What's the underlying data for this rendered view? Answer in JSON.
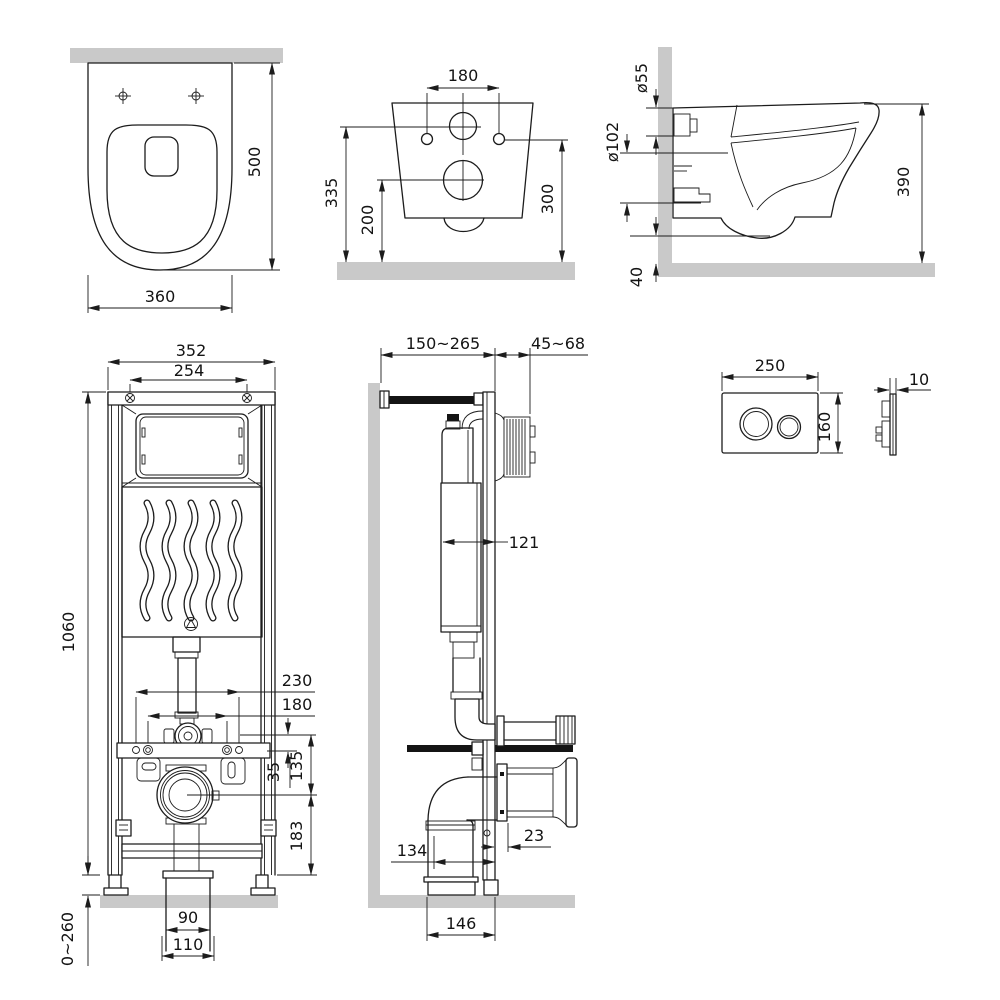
{
  "colors": {
    "surface": "#c9c9c9",
    "line": "#1c1c1c",
    "black_fill": "#141414"
  },
  "views": {
    "toilet_top": {
      "name": "Toilet bowl — top view",
      "dim_depth": "500",
      "dim_width": "360"
    },
    "toilet_rear": {
      "name": "Toilet bowl — rear view",
      "dim_hole_spacing": "180",
      "dim_inlet_height": "335",
      "dim_outlet_height": "200",
      "dim_fixing_height": "300"
    },
    "toilet_side": {
      "name": "Toilet bowl — side view",
      "dim_inlet_dia": "ø55",
      "dim_outlet_dia": "ø102",
      "dim_height": "390",
      "dim_floor_gap": "40"
    },
    "frame_front": {
      "name": "Installation frame — front view",
      "dim_width": "352",
      "dim_screw_spacing": "254",
      "dim_height": "1060",
      "dim_stud_outer": "230",
      "dim_stud_inner": "180",
      "dim_offset_small": "35",
      "dim_rail_to_outlet": "135",
      "dim_outlet_to_base": "183",
      "dim_leg_range": "0~260",
      "dim_drain_inner": "90",
      "dim_drain_outer": "110"
    },
    "frame_side": {
      "name": "Installation frame — side view",
      "dim_depth_range": "150~265",
      "dim_finish_range": "45~68",
      "dim_cistern_depth": "121",
      "dim_outlet_depth": "134",
      "dim_flange_depth": "23",
      "dim_drain_depth": "146"
    },
    "flush_plate": {
      "name": "Flush plate",
      "dim_width": "250",
      "dim_height": "160",
      "dim_thickness": "10"
    }
  }
}
